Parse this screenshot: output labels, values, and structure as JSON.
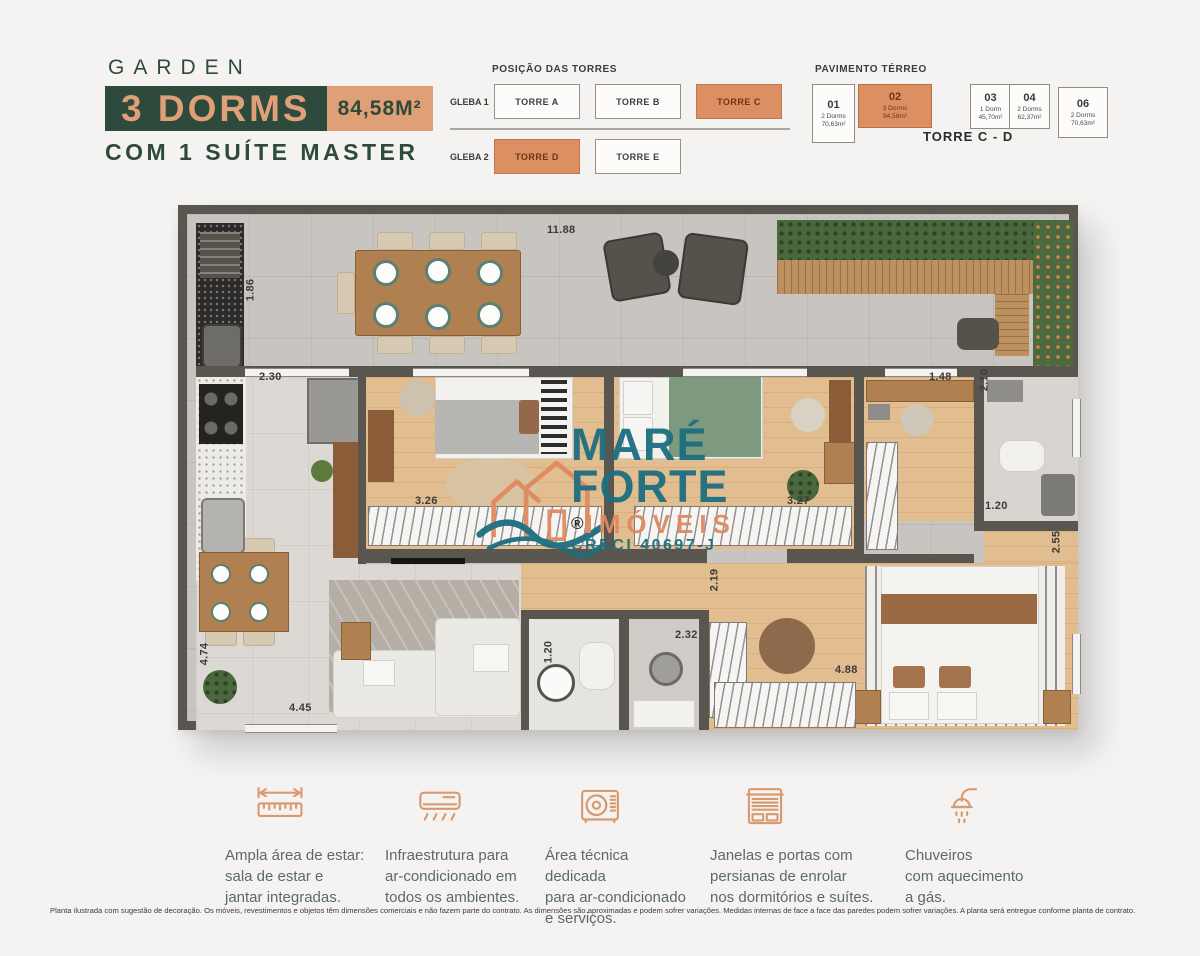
{
  "header": {
    "kicker": "GARDEN",
    "title": "3 DORMS",
    "area": "84,58M²",
    "subtitle": "COM 1 SUÍTE MASTER",
    "colors": {
      "green": "#2e4a3c",
      "salmon": "#dfa077",
      "highlight_orange": "#dc8f62"
    }
  },
  "towers": {
    "title": "POSIÇÃO DAS TORRES",
    "rows": [
      {
        "label": "GLEBA 1",
        "towers": [
          {
            "name": "TORRE A",
            "highlight": false
          },
          {
            "name": "TORRE B",
            "highlight": false
          },
          {
            "name": "TORRE C",
            "highlight": true
          }
        ]
      },
      {
        "label": "GLEBA 2",
        "towers": [
          {
            "name": "TORRE D",
            "highlight": true
          },
          {
            "name": "TORRE E",
            "highlight": false
          }
        ]
      }
    ]
  },
  "pavimento": {
    "title": "PAVIMENTO TÉRREO",
    "caption": "TORRE C - D",
    "units": [
      {
        "num": "01",
        "line1": "2 Dorms",
        "line2": "70,63m²",
        "highlight": false
      },
      {
        "num": "02",
        "line1": "3 Dorms",
        "line2": "84,58m²",
        "highlight": true
      },
      {
        "num": "03",
        "line1": "1 Dorm",
        "line2": "45,70m²",
        "highlight": false
      },
      {
        "num": "04",
        "line1": "2 Dorms",
        "line2": "62,37m²",
        "highlight": false
      },
      {
        "num": "06",
        "line1": "2 Dorms",
        "line2": "70,63m²",
        "highlight": false
      }
    ]
  },
  "plan": {
    "dimensions": [
      {
        "t": "11.88",
        "x": 360,
        "y": 10,
        "v": false
      },
      {
        "t": "1.86",
        "x": 52,
        "y": 70,
        "v": true
      },
      {
        "t": "2.30",
        "x": 72,
        "y": 157,
        "v": false
      },
      {
        "t": "3.26",
        "x": 228,
        "y": 281,
        "v": false
      },
      {
        "t": "3.27",
        "x": 600,
        "y": 281,
        "v": false
      },
      {
        "t": "1.48",
        "x": 742,
        "y": 157,
        "v": false
      },
      {
        "t": "2.10",
        "x": 786,
        "y": 160,
        "v": true
      },
      {
        "t": "1.20",
        "x": 798,
        "y": 286,
        "v": false
      },
      {
        "t": "2.55",
        "x": 858,
        "y": 322,
        "v": true
      },
      {
        "t": "2.19",
        "x": 516,
        "y": 360,
        "v": true
      },
      {
        "t": "2.32",
        "x": 488,
        "y": 415,
        "v": false
      },
      {
        "t": "1.20",
        "x": 350,
        "y": 432,
        "v": true
      },
      {
        "t": "4.88",
        "x": 648,
        "y": 450,
        "v": false
      },
      {
        "t": "4.74",
        "x": 6,
        "y": 434,
        "v": true
      },
      {
        "t": "4.45",
        "x": 102,
        "y": 488,
        "v": false
      }
    ]
  },
  "watermark": {
    "line1": "MARÉ",
    "line2": "FORTE",
    "line3": "IMÓVEIS",
    "line4": "CRECI 40697-J",
    "reg": "®",
    "teal": "#1c6e80",
    "orange": "#df8a5f"
  },
  "features": [
    {
      "icon": "ruler-icon",
      "lines": [
        "Ampla área de estar:",
        "sala de estar e",
        "jantar integradas."
      ]
    },
    {
      "icon": "ac-unit-icon",
      "lines": [
        "Infraestrutura para",
        "ar-condicionado em",
        "todos os ambientes."
      ]
    },
    {
      "icon": "ac-condenser-icon",
      "lines": [
        "Área técnica dedicada",
        "para ar-condicionado",
        "e serviços."
      ]
    },
    {
      "icon": "roller-blind-icon",
      "lines": [
        "Janelas e portas com",
        "persianas de enrolar",
        "nos dormitórios e suítes."
      ]
    },
    {
      "icon": "shower-icon",
      "lines": [
        "Chuveiros",
        "com aquecimento",
        "a gás."
      ]
    }
  ],
  "disclaimer": "Planta ilustrada com sugestão de decoração. Os móveis, revestimentos e objetos têm dimensões comerciais e não fazem parte do contrato. As dimensões são aproximadas e podem sofrer variações. Medidas internas de face a face das paredes podem sofrer variações. A planta será entregue conforme planta de contrato."
}
